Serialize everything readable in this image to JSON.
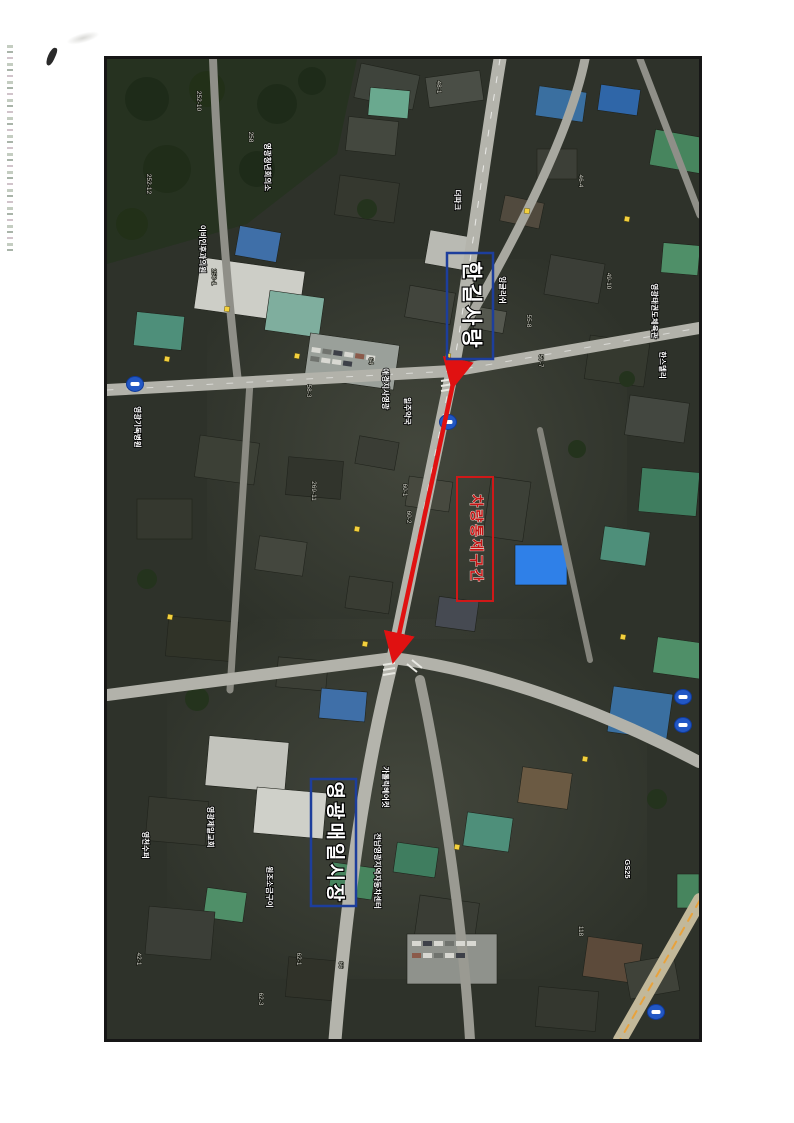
{
  "document": {
    "kind": "scanned aerial photo map page"
  },
  "annotations": {
    "hangil_label": "한길사랑",
    "restricted_label": "차량통제구간",
    "market_label": "영광매일시장",
    "colors": {
      "blue_box": "#1d3e9c",
      "red_box": "#d01818",
      "arrow": "#e01111"
    }
  },
  "map": {
    "labels": [
      {
        "text": "영광청년회의소",
        "x": 158,
        "y": 108
      },
      {
        "text": "이비인후과의원",
        "x": 93,
        "y": 190
      },
      {
        "text": "영광기독병원",
        "x": 28,
        "y": 368
      },
      {
        "text": "일주약국",
        "x": 298,
        "y": 352
      },
      {
        "text": "애경지사영광",
        "x": 276,
        "y": 330
      },
      {
        "text": "더파크",
        "x": 348,
        "y": 141
      },
      {
        "text": "잉글리쉬",
        "x": 393,
        "y": 231
      },
      {
        "text": "영광태권도체육관",
        "x": 545,
        "y": 252
      },
      {
        "text": "한스델리",
        "x": 553,
        "y": 306
      },
      {
        "text": "원조소금구이",
        "x": 160,
        "y": 828
      },
      {
        "text": "영천수퍼",
        "x": 36,
        "y": 786
      },
      {
        "text": "영광제일교회",
        "x": 101,
        "y": 768
      },
      {
        "text": "가톨릭헤어컷",
        "x": 276,
        "y": 728
      },
      {
        "text": "전남영광지역자동차센터",
        "x": 268,
        "y": 812
      },
      {
        "text": "GS25",
        "x": 518,
        "y": 810
      }
    ],
    "parcels": [
      {
        "text": "252-10",
        "x": 90,
        "y": 42
      },
      {
        "text": "252-12",
        "x": 40,
        "y": 125
      },
      {
        "text": "258",
        "x": 142,
        "y": 78
      },
      {
        "text": "250-1",
        "x": 105,
        "y": 218
      },
      {
        "text": "48-1",
        "x": 330,
        "y": 28
      },
      {
        "text": "49-10",
        "x": 500,
        "y": 222
      },
      {
        "text": "46-4",
        "x": 472,
        "y": 122
      },
      {
        "text": "58-3",
        "x": 200,
        "y": 332
      },
      {
        "text": "57-7",
        "x": 432,
        "y": 302
      },
      {
        "text": "55-8",
        "x": 420,
        "y": 262
      },
      {
        "text": "64",
        "x": 262,
        "y": 302
      },
      {
        "text": "60-1",
        "x": 296,
        "y": 431
      },
      {
        "text": "60-2",
        "x": 300,
        "y": 458
      },
      {
        "text": "269-11",
        "x": 205,
        "y": 432
      },
      {
        "text": "62-1",
        "x": 190,
        "y": 900
      },
      {
        "text": "62-3",
        "x": 152,
        "y": 940
      },
      {
        "text": "66",
        "x": 232,
        "y": 906
      },
      {
        "text": "118",
        "x": 472,
        "y": 872
      },
      {
        "text": "42-1",
        "x": 30,
        "y": 900
      }
    ],
    "route_badges": [
      {
        "x": 28,
        "y": 325
      },
      {
        "x": 341,
        "y": 363
      },
      {
        "x": 576,
        "y": 638
      },
      {
        "x": 576,
        "y": 666
      },
      {
        "x": 549,
        "y": 953
      }
    ],
    "poi_markers": [
      {
        "x": 120,
        "y": 250
      },
      {
        "x": 190,
        "y": 297
      },
      {
        "x": 341,
        "y": 297
      },
      {
        "x": 420,
        "y": 152
      },
      {
        "x": 258,
        "y": 585
      },
      {
        "x": 350,
        "y": 788
      },
      {
        "x": 478,
        "y": 700
      },
      {
        "x": 250,
        "y": 470
      },
      {
        "x": 63,
        "y": 558
      },
      {
        "x": 516,
        "y": 578
      },
      {
        "x": 60,
        "y": 300
      },
      {
        "x": 520,
        "y": 160
      }
    ]
  }
}
